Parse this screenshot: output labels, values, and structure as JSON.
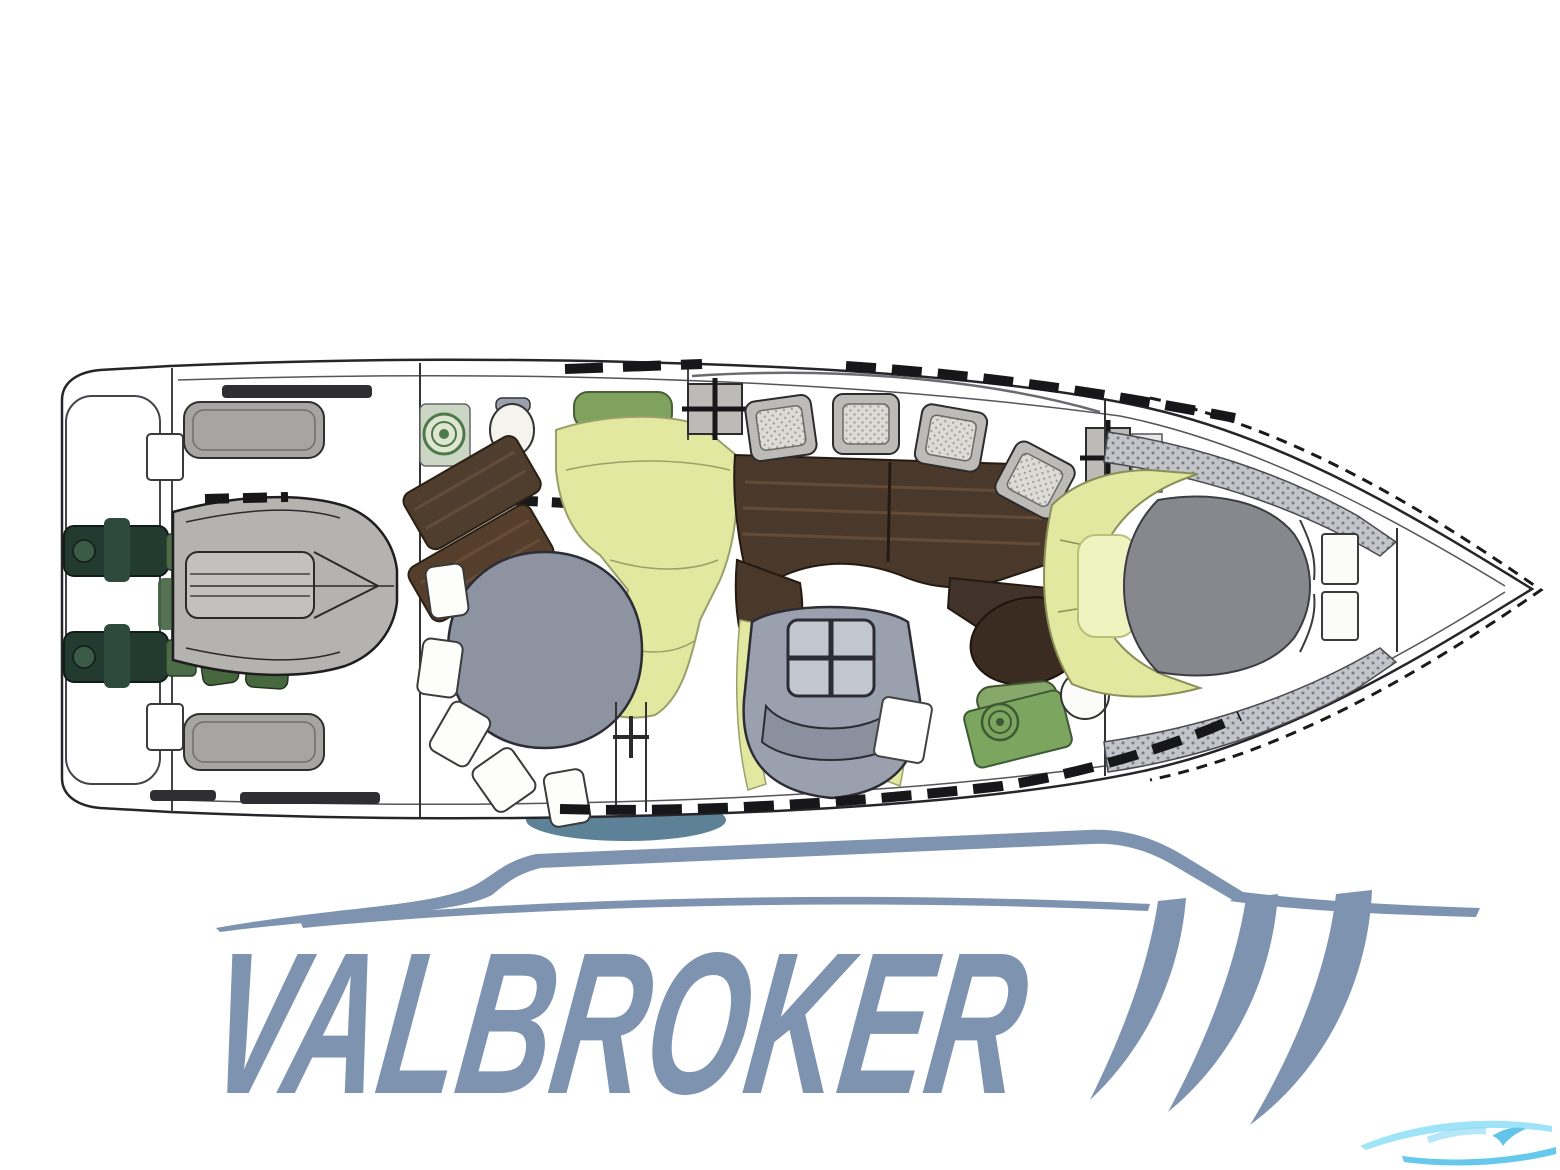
{
  "logo": {
    "text": "VALBROKER",
    "color": "#7d93af"
  },
  "plan": {
    "type": "motor-yacht-deck-plan",
    "orientation": "bow-right",
    "colors": {
      "outline": "#26262a",
      "upholstery_yellow": "#e2e89f",
      "pale_yellow": "#eff3c0",
      "table_gray": "#8e93a2",
      "helm_gray": "#9aa0ad",
      "wood_brown": "#4a392b",
      "tender_gray": "#b4b3af",
      "engine_green": "#243a31",
      "pad_green": "#7fa35f",
      "bed_gray": "#87888e",
      "deck_gray": "#c3c5ca",
      "hull_shadow_slate": "#5d8196"
    },
    "features": [
      "swim-platform",
      "stern-bench-seats",
      "tender-dinghy",
      "twin-engines",
      "galley-stove",
      "head-toilet",
      "cockpit-settee",
      "cockpit-table",
      "salon-dining-table",
      "salon-chairs",
      "deck-hatches",
      "helm-double-seat",
      "round-table",
      "sink-unit",
      "bow-cabin-berth",
      "bow-side-decks",
      "bow-rail"
    ]
  },
  "watermark": {
    "colors": [
      "#8edff6",
      "#4cc0e8"
    ]
  }
}
